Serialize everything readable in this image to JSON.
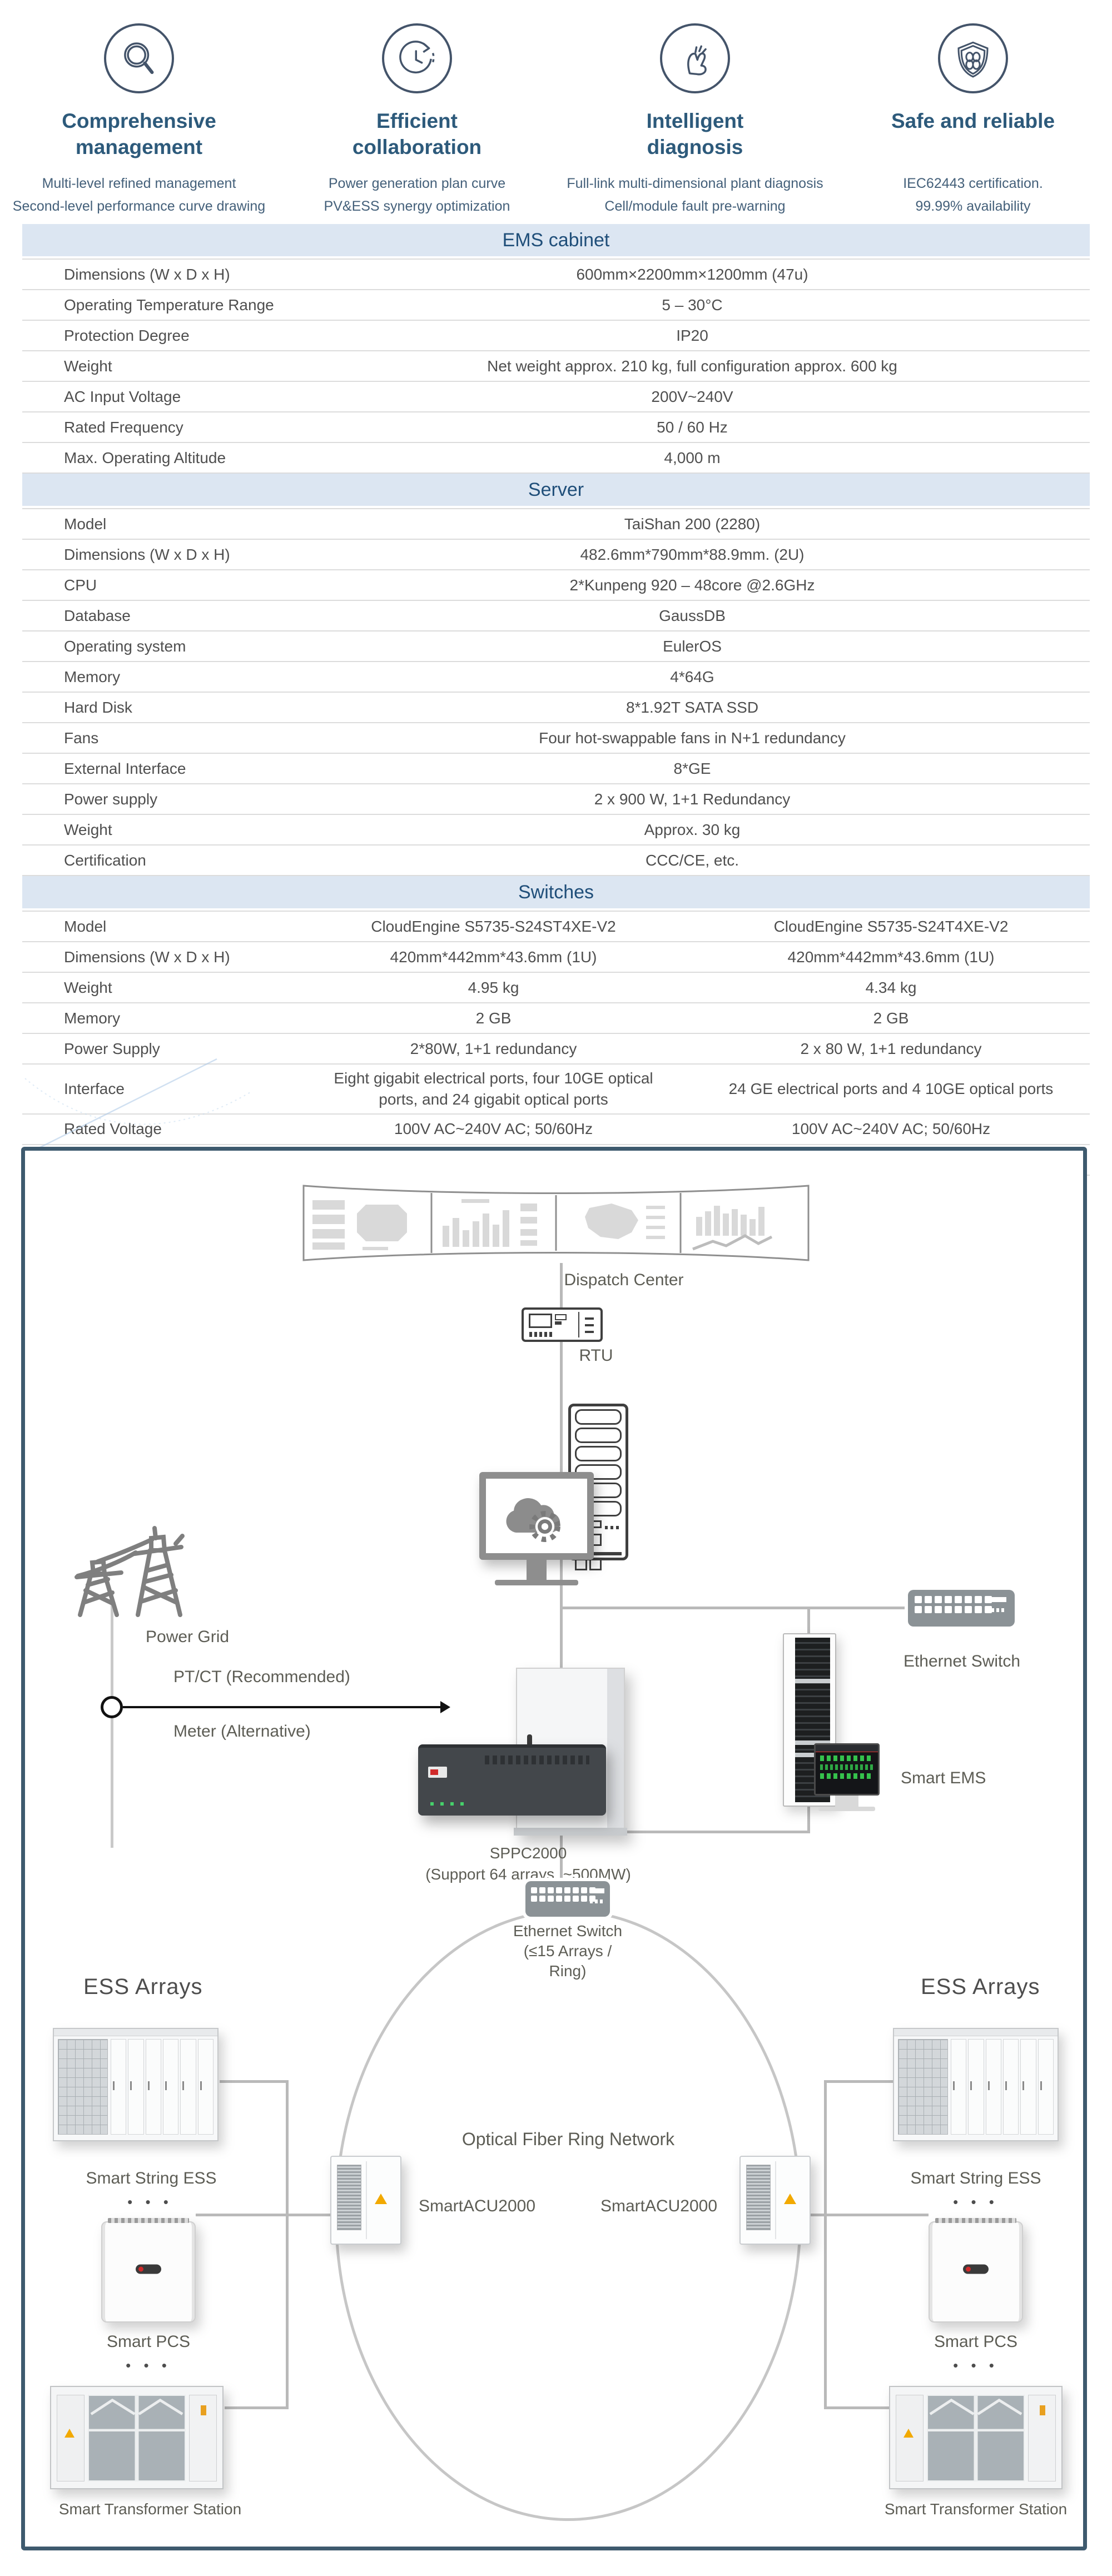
{
  "features": [
    {
      "icon": "magnifier-icon",
      "title_line1": "Comprehensive",
      "title_line2": "management",
      "desc_line1": "Multi-level refined management",
      "desc_line2": "Second-level performance curve drawing"
    },
    {
      "icon": "cycle-clock-icon",
      "title_line1": "Efficient",
      "title_line2": "collaboration",
      "desc_line1": "Power generation plan curve",
      "desc_line2": "PV&ESS  synergy optimization"
    },
    {
      "icon": "snap-finger-icon",
      "title_line1": "Intelligent",
      "title_line2": "diagnosis",
      "desc_line1": "Full-link multi-dimensional plant diagnosis",
      "desc_line2": "Cell/module fault pre-warning"
    },
    {
      "icon": "shield-icon",
      "title_line1": "Safe and reliable",
      "title_line2": "",
      "desc_line1": "IEC62443 certification.",
      "desc_line2": "99.99% availability"
    }
  ],
  "tables": [
    {
      "title": "EMS cabinet",
      "rows": [
        {
          "label": "Dimensions (W x D x H)",
          "values": [
            "600mm×2200mm×1200mm (47u)"
          ]
        },
        {
          "label": "Operating Temperature Range",
          "values": [
            "5 – 30°C"
          ]
        },
        {
          "label": "Protection Degree",
          "values": [
            "IP20"
          ]
        },
        {
          "label": "Weight",
          "values": [
            "Net weight approx. 210 kg, full configuration approx. 600 kg"
          ]
        },
        {
          "label": "AC Input Voltage",
          "values": [
            "200V~240V"
          ]
        },
        {
          "label": "Rated Frequency",
          "values": [
            "50 / 60 Hz"
          ]
        },
        {
          "label": "Max. Operating Altitude",
          "values": [
            "4,000 m"
          ]
        }
      ]
    },
    {
      "title": "Server",
      "rows": [
        {
          "label": "Model",
          "values": [
            "TaiShan 200 (2280)"
          ]
        },
        {
          "label": "Dimensions (W x D x H)",
          "values": [
            "482.6mm*790mm*88.9mm. (2U)"
          ]
        },
        {
          "label": "CPU",
          "values": [
            "2*Kunpeng 920 – 48core @2.6GHz"
          ]
        },
        {
          "label": "Database",
          "values": [
            "GaussDB"
          ]
        },
        {
          "label": "Operating system",
          "values": [
            "EulerOS"
          ]
        },
        {
          "label": "Memory",
          "values": [
            "4*64G"
          ]
        },
        {
          "label": "Hard Disk",
          "values": [
            "8*1.92T SATA SSD"
          ]
        },
        {
          "label": "Fans",
          "values": [
            "Four hot-swappable fans in N+1 redundancy"
          ]
        },
        {
          "label": "External Interface",
          "values": [
            "8*GE"
          ]
        },
        {
          "label": "Power supply",
          "values": [
            "2 x 900 W, 1+1 Redundancy"
          ]
        },
        {
          "label": "Weight",
          "values": [
            "Approx. 30 kg"
          ]
        },
        {
          "label": "Certification",
          "values": [
            "CCC/CE, etc."
          ]
        }
      ]
    },
    {
      "title": "Switches",
      "rows": [
        {
          "label": "Model",
          "values": [
            "CloudEngine S5735-S24ST4XE-V2",
            "CloudEngine S5735-S24T4XE-V2"
          ]
        },
        {
          "label": "Dimensions (W x D x H)",
          "values": [
            "420mm*442mm*43.6mm (1U)",
            "420mm*442mm*43.6mm (1U)"
          ]
        },
        {
          "label": "Weight",
          "values": [
            "4.95 kg",
            "4.34 kg"
          ]
        },
        {
          "label": "Memory",
          "values": [
            "2 GB",
            "2 GB"
          ]
        },
        {
          "label": "Power Supply",
          "values": [
            "2*80W, 1+1 redundancy",
            "2 x 80 W, 1+1 redundancy"
          ]
        },
        {
          "label": "Interface",
          "values": [
            "Eight gigabit electrical ports, four 10GE optical ports, and 24 gigabit optical ports",
            "24 GE electrical ports and 4 10GE optical ports"
          ]
        },
        {
          "label": "Rated Voltage",
          "values": [
            "100V AC~240V AC; 50/60Hz",
            "100V AC~240V AC; 50/60Hz"
          ]
        },
        {
          "label": "Certification",
          "values": [
            "CE/VCCI, etc.",
            "CE/VCCI, etc."
          ]
        }
      ]
    }
  ],
  "diagram": {
    "dispatch_center": "Dispatch Center",
    "rtu": "RTU",
    "power_grid": "Power Grid",
    "ptct": "PT/CT (Recommended)",
    "meter": "Meter (Alternative)",
    "sppc_name": "SPPC2000",
    "sppc_sub": "(Support 64 arrays, ~500MW)",
    "ethernet_switch_right": "Ethernet Switch",
    "smart_ems": "Smart EMS",
    "ring_switch_line1": "Ethernet Switch",
    "ring_switch_line2": "(≤15 Arrays /",
    "ring_switch_line3": "Ring)",
    "ring_label": "Optical Fiber Ring Network",
    "acu_left": "SmartACU2000",
    "acu_right": "SmartACU2000",
    "left_column": {
      "heading": "ESS Arrays",
      "ess": "Smart String ESS",
      "pcs": "Smart PCS",
      "transformer": "Smart Transformer Station",
      "dots": "• • •"
    },
    "right_column": {
      "heading": "ESS Arrays",
      "ess": "Smart String ESS",
      "pcs": "Smart PCS",
      "transformer": "Smart Transformer Station",
      "dots": "• • •"
    }
  },
  "colors": {
    "section_header_bg": "#dce6f2",
    "section_header_text": "#1f4e79",
    "diagram_border": "#3e5a6e",
    "warning_triangle": "#f2a900",
    "line_gray": "#b9b9b9"
  }
}
